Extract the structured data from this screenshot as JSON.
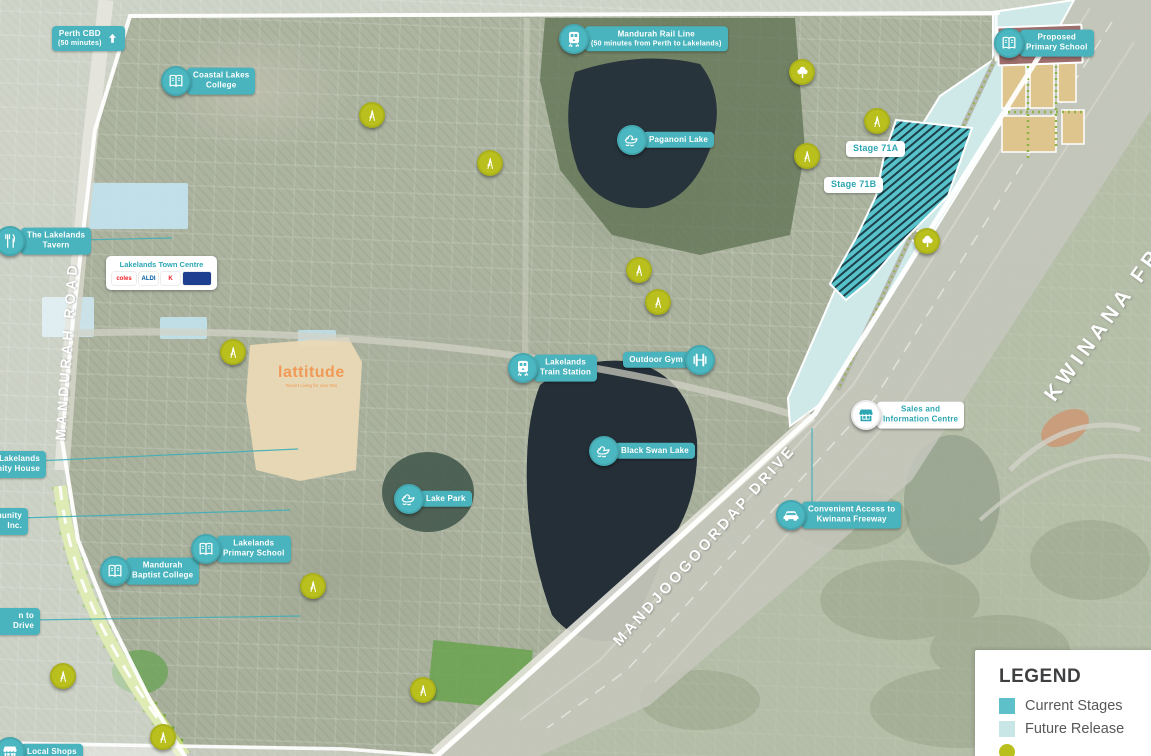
{
  "roads": {
    "mandurah_road": "MANDURAH ROAD",
    "kwinana_freeway": "KWINANA FREEWAY",
    "mandjoogoordap_drive": "MANDJOOGOORDAP DRIVE"
  },
  "estate": {
    "lattitude_name": "lattitude",
    "lattitude_tagline": "Resort Living for over 55s"
  },
  "town_centre": {
    "title": "Lakelands Town Centre",
    "logos": [
      {
        "name": "coles",
        "text": "coles",
        "color": "#ed1c24",
        "bg": "#ffffff",
        "w": 20
      },
      {
        "name": "aldi",
        "text": "ALDI",
        "color": "#00579d",
        "bg": "#ffffff",
        "w": 15
      },
      {
        "name": "kmart",
        "text": "K",
        "color": "#ed1c24",
        "bg": "#ffffff",
        "w": 14
      },
      {
        "name": "brand",
        "text": "",
        "color": "#ffffff",
        "bg": "#1e3e8f",
        "w": 24
      }
    ]
  },
  "legend": {
    "title": "LEGEND",
    "items": [
      {
        "label": "Current Stages",
        "swatch": "square",
        "color": "#5ec1c9"
      },
      {
        "label": "Future Release",
        "swatch": "square",
        "color": "#c9e6e6"
      },
      {
        "label": "",
        "swatch": "circle",
        "color": "#b9c01d"
      }
    ]
  },
  "colors": {
    "marker_teal": "#4bb7c0",
    "pin_olive": "#b9c01d",
    "badge_teal": "#49b4bd",
    "future_release": "#cfe9e8",
    "current_stage": "#58c2ca",
    "school_block": "#9c6e6c",
    "lattitude_orange": "#f19a57"
  },
  "markers": [
    {
      "id": "perth-cbd",
      "kind": "badge_arrow",
      "lines": [
        "Perth CBD",
        "(50 minutes)"
      ],
      "x": 52,
      "y": 26
    },
    {
      "id": "coastal-lakes-college",
      "kind": "poi",
      "icon": "book",
      "lines": [
        "Coastal Lakes",
        "College"
      ],
      "x": 176,
      "y": 81
    },
    {
      "id": "mandurah-rail-line",
      "kind": "poi",
      "icon": "train",
      "lines": [
        "Mandurah Rail Line",
        "(50 minutes from Perth to Lakelands)"
      ],
      "x": 574,
      "y": 39
    },
    {
      "id": "paganoni-lake",
      "kind": "poi",
      "icon": "duck",
      "lines": [
        "Paganoni Lake"
      ],
      "x": 632,
      "y": 140
    },
    {
      "id": "proposed-primary-school",
      "kind": "poi",
      "icon": "book",
      "lines": [
        "Proposed",
        "Primary School"
      ],
      "x": 1009,
      "y": 43
    },
    {
      "id": "the-lakelands-tavern",
      "kind": "poi",
      "icon": "cutlery",
      "lines": [
        "The Lakelands",
        "Tavern"
      ],
      "x": 10,
      "y": 241,
      "leader": [
        78,
        240,
        172,
        238
      ]
    },
    {
      "id": "lakelands-train-station",
      "kind": "poi",
      "icon": "train",
      "lines": [
        "Lakelands",
        "Train Station"
      ],
      "x": 523,
      "y": 368
    },
    {
      "id": "outdoor-gym",
      "kind": "poi",
      "icon": "gym",
      "lines": [
        "Outdoor Gym"
      ],
      "x": 700,
      "y": 360,
      "side": "left"
    },
    {
      "id": "black-swan-lake",
      "kind": "poi",
      "icon": "duck",
      "lines": [
        "Black Swan Lake"
      ],
      "x": 604,
      "y": 451
    },
    {
      "id": "sales-and-information-centre",
      "kind": "poi",
      "icon": "shop",
      "style": "white",
      "lines": [
        "Sales and",
        "Information Centre"
      ],
      "x": 866,
      "y": 415
    },
    {
      "id": "convenient-access-to-kwinana-freeway",
      "kind": "poi",
      "icon": "car",
      "lines": [
        "Convenient Access to",
        "Kwinana Freeway"
      ],
      "x": 791,
      "y": 515,
      "leader": [
        812,
        428,
        812,
        504
      ]
    },
    {
      "id": "lake-park",
      "kind": "poi",
      "icon": "duck",
      "lines": [
        "Lake Park"
      ],
      "x": 409,
      "y": 499
    },
    {
      "id": "lakelands-primary-school",
      "kind": "poi",
      "icon": "book",
      "lines": [
        "Lakelands",
        "Primary School"
      ],
      "x": 206,
      "y": 549
    },
    {
      "id": "mandurah-baptist-college",
      "kind": "poi",
      "icon": "book",
      "lines": [
        "Mandurah",
        "Baptist College"
      ],
      "x": 115,
      "y": 571
    },
    {
      "id": "local-shops",
      "kind": "poi",
      "icon": "shop",
      "lines": [
        "Local Shops"
      ],
      "x": 10,
      "y": 752
    },
    {
      "id": "stage-71a",
      "kind": "stage",
      "lines": [
        "Stage 71A"
      ],
      "x": 846,
      "y": 141
    },
    {
      "id": "stage-71b",
      "kind": "stage",
      "lines": [
        "Stage 71B"
      ],
      "x": 824,
      "y": 177
    },
    {
      "id": "community-house",
      "kind": "edge_badge",
      "lines": [
        "Lakelands",
        "Community House"
      ],
      "x": -66,
      "y": 451,
      "w": 100,
      "leader": [
        36,
        461,
        298,
        449
      ]
    },
    {
      "id": "community-inc",
      "kind": "edge_badge",
      "lines": [
        "Community",
        "Inc."
      ],
      "x": -58,
      "y": 508,
      "w": 74,
      "leader": [
        18,
        518,
        290,
        510
      ]
    },
    {
      "id": "access-drive",
      "kind": "edge_badge",
      "lines": [
        "n to",
        "Drive"
      ],
      "x": -30,
      "y": 608,
      "w": 58,
      "leader": [
        30,
        620,
        300,
        616
      ]
    },
    {
      "id": "playground-1",
      "kind": "pin",
      "icon": "slide",
      "x": 372,
      "y": 115
    },
    {
      "id": "playground-2",
      "kind": "pin",
      "icon": "slide",
      "x": 490,
      "y": 163
    },
    {
      "id": "playground-3",
      "kind": "pin",
      "icon": "slide",
      "x": 877,
      "y": 121
    },
    {
      "id": "playground-4",
      "kind": "pin",
      "icon": "slide",
      "x": 807,
      "y": 156
    },
    {
      "id": "playground-5",
      "kind": "pin",
      "icon": "slide",
      "x": 639,
      "y": 270
    },
    {
      "id": "playground-6",
      "kind": "pin",
      "icon": "slide",
      "x": 658,
      "y": 302
    },
    {
      "id": "playground-7",
      "kind": "pin",
      "icon": "slide",
      "x": 233,
      "y": 352
    },
    {
      "id": "playground-8",
      "kind": "pin",
      "icon": "slide",
      "x": 313,
      "y": 586
    },
    {
      "id": "playground-9",
      "kind": "pin",
      "icon": "slide",
      "x": 63,
      "y": 676
    },
    {
      "id": "playground-10",
      "kind": "pin",
      "icon": "slide",
      "x": 423,
      "y": 690
    },
    {
      "id": "playground-11",
      "kind": "pin",
      "icon": "slide",
      "x": 163,
      "y": 737
    },
    {
      "id": "trees-1",
      "kind": "pin",
      "icon": "tree",
      "x": 802,
      "y": 72
    },
    {
      "id": "trees-2",
      "kind": "pin",
      "icon": "tree",
      "x": 927,
      "y": 241
    }
  ]
}
